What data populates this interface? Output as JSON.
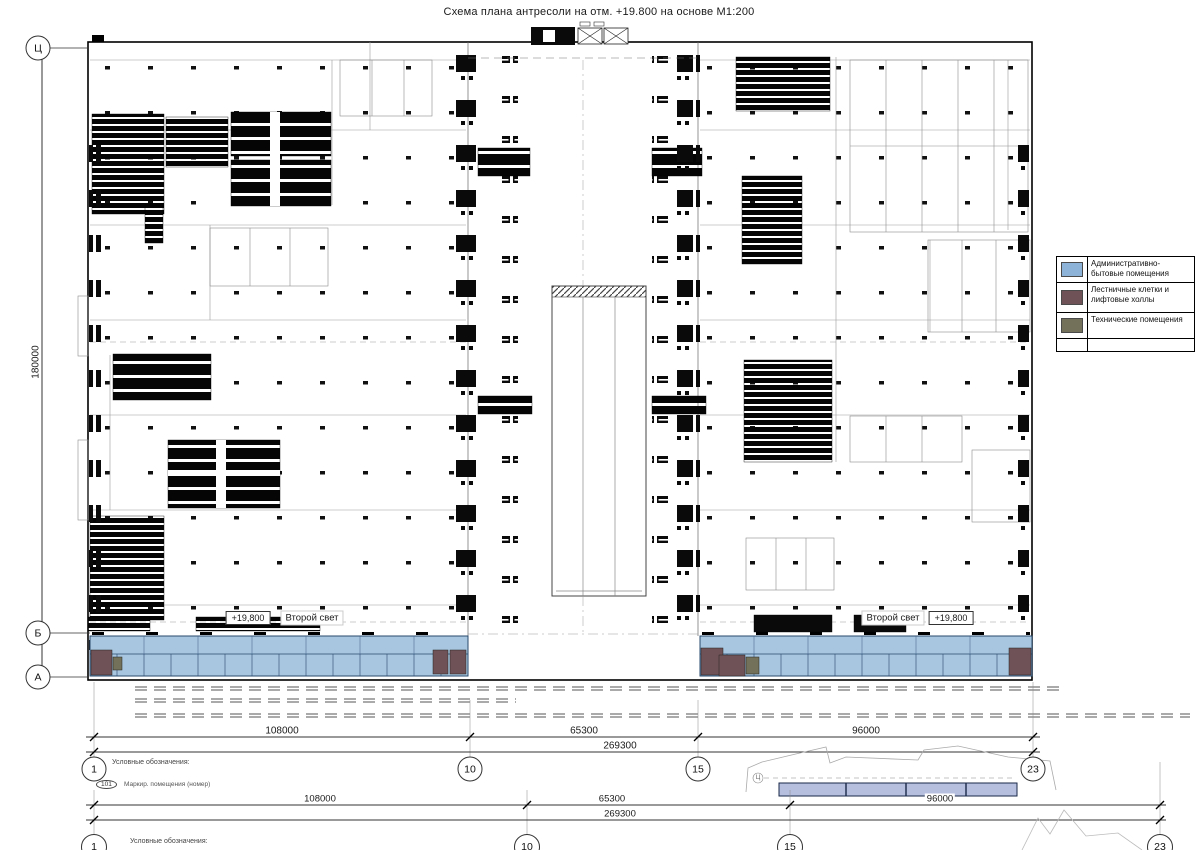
{
  "title": "Схема плана антресоли на отм. +19.800 на основе М1:200",
  "legend": {
    "items": [
      {
        "label": "Административно-бытовые помещения",
        "color": "#8db3d8"
      },
      {
        "label": "Лестничные клетки и лифтовые холлы",
        "color": "#6f5257"
      },
      {
        "label": "Технические помещения",
        "color": "#73715a"
      }
    ]
  },
  "grid_axes": {
    "rows": [
      {
        "label": "Ц"
      },
      {
        "label": "Б"
      },
      {
        "label": "А"
      }
    ],
    "cols": [
      {
        "label": "1"
      },
      {
        "label": "10"
      },
      {
        "label": "15"
      },
      {
        "label": "23"
      }
    ]
  },
  "dimensions": {
    "vertical_total": "180000",
    "segments": [
      "108000",
      "65300",
      "96000"
    ],
    "total": "269300"
  },
  "plan_labels": {
    "elevation_mark": "+19,800",
    "second_light": "Второй свет"
  },
  "notes": {
    "heading": "Условные обозначения:",
    "room_mark_number": "101",
    "room_mark_text": "Маркир. помещения (номер)"
  },
  "key_plan": {
    "axis_label": "Ц"
  },
  "colors": {
    "admin_fill": "#a9c6e0",
    "admin_line": "#27496d",
    "stair_fill": "#6f5257",
    "tech_fill": "#73715a",
    "key_plan_bar": "#b7bfdf"
  }
}
